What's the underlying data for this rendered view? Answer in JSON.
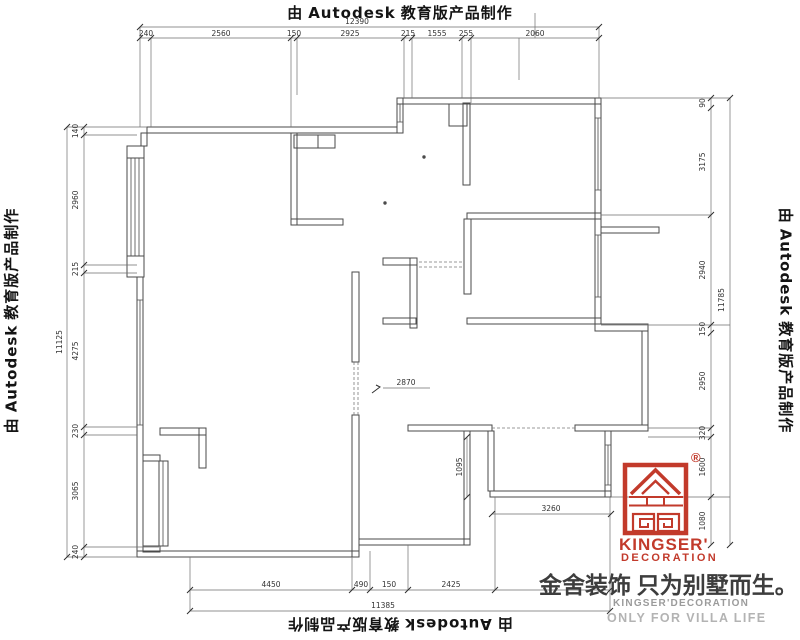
{
  "watermark": {
    "prefix": "由",
    "brand": "Autodesk",
    "suffix": "教育版产品制作"
  },
  "dimensions": {
    "top": {
      "total": "12390",
      "segments": [
        "240",
        "2560",
        "150",
        "2925",
        "215",
        "1555",
        "255",
        "2060"
      ]
    },
    "bottom": {
      "total": "11385",
      "segments": [
        "4450",
        "490",
        "150",
        "2425"
      ]
    },
    "left": {
      "total": "11125",
      "segments": [
        "140",
        "2960",
        "215",
        "4275",
        "230",
        "3065",
        "240"
      ]
    },
    "right": {
      "total": "11785",
      "segments": [
        "90",
        "3175",
        "2940",
        "150",
        "2950",
        "320",
        "1600",
        "1080"
      ]
    },
    "interior": {
      "level_mark": "2870",
      "room_width": "1095",
      "room_length": "3260"
    }
  },
  "logo": {
    "registered": "®",
    "name_top": "KINGSER'",
    "name_bottom": "DECORATION",
    "slogan_cn": "金舍装饰 只为别墅而生。",
    "name_en": "KINGSER'DECORATION",
    "tagline_en": "ONLY FOR VILLA LIFE"
  },
  "colors": {
    "brand_red": "#c23a2b",
    "wall_line": "#4a4a4a",
    "dim_line": "#6f6f6f",
    "watermark_text": "#141414",
    "slogan_gray": "#3d3d3d",
    "muted_gray": "#9b9b9b"
  }
}
